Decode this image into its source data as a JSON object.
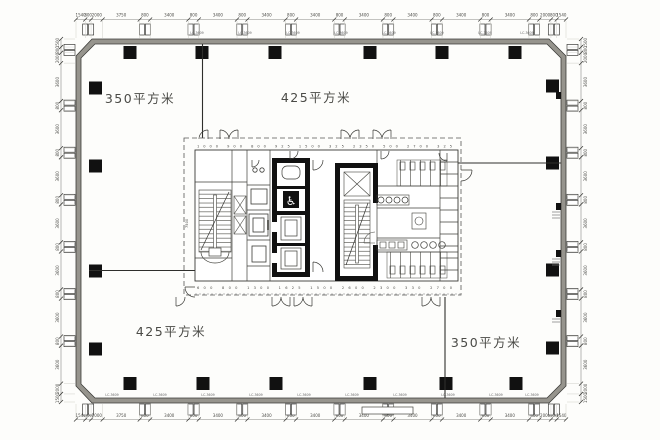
{
  "drawing": {
    "area_labels": {
      "top_left": "350平方米",
      "top_center": "425平方米",
      "bottom_left": "425平方米",
      "bottom_right": "350平方米"
    },
    "window_tag": "LC-3609",
    "core": {
      "dims_top": "1000 900 800 925 1500 325 2350 500 2700 325",
      "dims_bottom": "600 800 1300 1625 1500 2600 2300 330 2700",
      "dim_left": "7500",
      "accessible_icon": "♿"
    },
    "dims": {
      "top": [
        {
          "t": "1540",
          "w": 8
        },
        {
          "t": "800",
          "w": 5
        },
        {
          "t": "2000",
          "w": 10
        },
        {
          "t": "3750",
          "w": 32
        },
        {
          "t": "800",
          "w": 9
        },
        {
          "t": "3400",
          "w": 33
        },
        {
          "t": "800",
          "w": 9
        },
        {
          "t": "3400",
          "w": 33
        },
        {
          "t": "800",
          "w": 9
        },
        {
          "t": "3400",
          "w": 33
        },
        {
          "t": "800",
          "w": 9
        },
        {
          "t": "3400",
          "w": 33
        },
        {
          "t": "800",
          "w": 9
        },
        {
          "t": "3400",
          "w": 33
        },
        {
          "t": "800",
          "w": 9
        },
        {
          "t": "3400",
          "w": 33
        },
        {
          "t": "800",
          "w": 9
        },
        {
          "t": "3400",
          "w": 33
        },
        {
          "t": "800",
          "w": 9
        },
        {
          "t": "3400",
          "w": 33
        },
        {
          "t": "800",
          "w": 9
        },
        {
          "t": "2000",
          "w": 10
        },
        {
          "t": "800",
          "w": 5
        },
        {
          "t": "1540",
          "w": 8
        }
      ],
      "bottom": [
        {
          "t": "1540",
          "w": 8
        },
        {
          "t": "800",
          "w": 5
        },
        {
          "t": "2000",
          "w": 10
        },
        {
          "t": "3750",
          "w": 32
        },
        {
          "t": "800",
          "w": 9
        },
        {
          "t": "3400",
          "w": 33
        },
        {
          "t": "800",
          "w": 9
        },
        {
          "t": "3400",
          "w": 33
        },
        {
          "t": "800",
          "w": 9
        },
        {
          "t": "3400",
          "w": 33
        },
        {
          "t": "800",
          "w": 9
        },
        {
          "t": "3400",
          "w": 33
        },
        {
          "t": "800",
          "w": 9
        },
        {
          "t": "3400",
          "w": 33
        },
        {
          "t": "800",
          "w": 9
        },
        {
          "t": "3400",
          "w": 33
        },
        {
          "t": "800",
          "w": 9
        },
        {
          "t": "3400",
          "w": 33
        },
        {
          "t": "800",
          "w": 9
        },
        {
          "t": "3400",
          "w": 33
        },
        {
          "t": "800",
          "w": 9
        },
        {
          "t": "2000",
          "w": 10
        },
        {
          "t": "800",
          "w": 5
        },
        {
          "t": "1540",
          "w": 8
        }
      ],
      "left": [
        {
          "t": "1500",
          "w": 7
        },
        {
          "t": "800",
          "w": 5
        },
        {
          "t": "2000",
          "w": 9
        },
        {
          "t": "3600",
          "w": 33
        },
        {
          "t": "800",
          "w": 8
        },
        {
          "t": "3600",
          "w": 33
        },
        {
          "t": "800",
          "w": 8
        },
        {
          "t": "3600",
          "w": 33
        },
        {
          "t": "800",
          "w": 8
        },
        {
          "t": "3600",
          "w": 33
        },
        {
          "t": "800",
          "w": 8
        },
        {
          "t": "3600",
          "w": 33
        },
        {
          "t": "800",
          "w": 8
        },
        {
          "t": "3600",
          "w": 33
        },
        {
          "t": "800",
          "w": 8
        },
        {
          "t": "3600",
          "w": 33
        },
        {
          "t": "2000",
          "w": 9
        },
        {
          "t": "1500",
          "w": 7
        }
      ],
      "right": [
        {
          "t": "1500",
          "w": 7
        },
        {
          "t": "800",
          "w": 5
        },
        {
          "t": "2000",
          "w": 9
        },
        {
          "t": "3600",
          "w": 33
        },
        {
          "t": "800",
          "w": 8
        },
        {
          "t": "3600",
          "w": 33
        },
        {
          "t": "800",
          "w": 8
        },
        {
          "t": "3600",
          "w": 33
        },
        {
          "t": "800",
          "w": 8
        },
        {
          "t": "3600",
          "w": 33
        },
        {
          "t": "800",
          "w": 8
        },
        {
          "t": "3600",
          "w": 33
        },
        {
          "t": "800",
          "w": 8
        },
        {
          "t": "3600",
          "w": 33
        },
        {
          "t": "800",
          "w": 8
        },
        {
          "t": "3600",
          "w": 33
        },
        {
          "t": "2000",
          "w": 9
        },
        {
          "t": "1500",
          "w": 7
        }
      ]
    }
  }
}
